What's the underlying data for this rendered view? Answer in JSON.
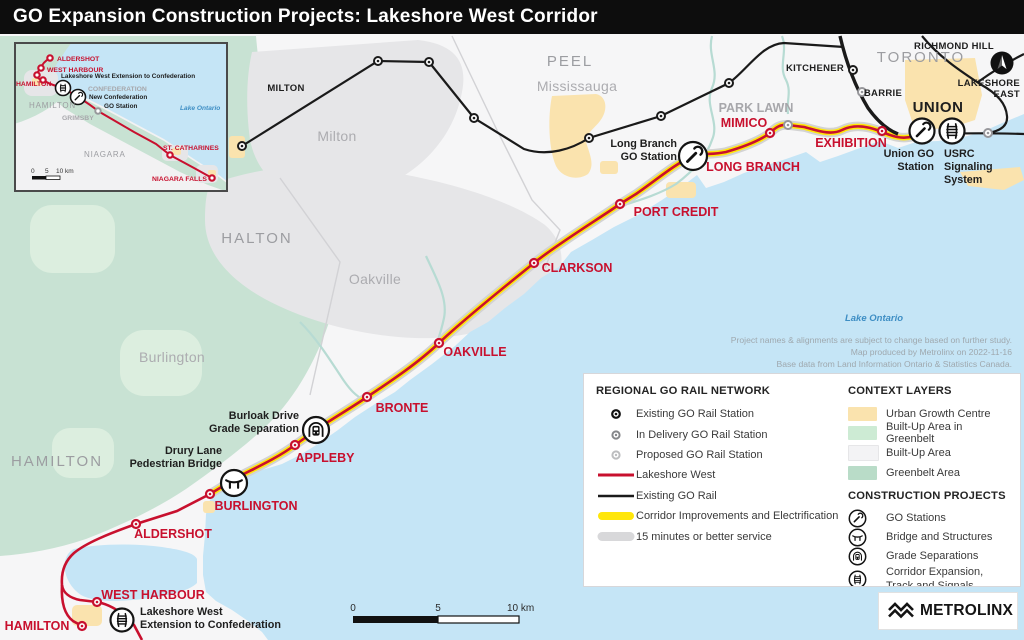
{
  "title": "GO Expansion Construction Projects: Lakeshore West Corridor",
  "regions": {
    "peel": "PEEL",
    "mississauga": "Mississauga",
    "milton": "Milton",
    "halton": "HALTON",
    "oakville": "Oakville",
    "burlington": "Burlington",
    "hamilton": "HAMILTON",
    "toronto": "TORONTO"
  },
  "lines": {
    "milton": "MILTON",
    "kitchener": "KITCHENER",
    "barrie": "BARRIE",
    "richmond_hill": "RICHMOND HILL",
    "lakeshore_east_1": "LAKESHORE",
    "lakeshore_east_2": "EAST",
    "union": "UNION"
  },
  "stations": {
    "park_lawn": "PARK LAWN",
    "mimico": "MIMICO",
    "exhibition": "EXHIBITION",
    "long_branch": "LONG BRANCH",
    "port_credit": "PORT CREDIT",
    "clarkson": "CLARKSON",
    "oakville": "OAKVILLE",
    "bronte": "BRONTE",
    "appleby": "APPLEBY",
    "burlington": "BURLINGTON",
    "aldershot": "ALDERSHOT",
    "west_harbour": "WEST HARBOUR",
    "hamilton": "HAMILTON"
  },
  "projects": {
    "long_branch_go_1": "Long Branch",
    "long_branch_go_2": "GO Station",
    "union_go_1": "Union GO",
    "union_go_2": "Station",
    "usrc_1": "USRC",
    "usrc_2": "Signaling",
    "usrc_3": "System",
    "burloak_1": "Burloak Drive",
    "burloak_2": "Grade Separation",
    "drury_1": "Drury Lane",
    "drury_2": "Pedestrian Bridge",
    "ext_1": "Lakeshore West",
    "ext_2": "Extension to Confederation"
  },
  "water": {
    "lake_ontario": "Lake Ontario"
  },
  "notes": {
    "line1": "Project names & alignments are subject to change based on further study.",
    "line2": "Map produced by Metrolinx on 2022-11-16",
    "line3": "Base data from Land Information Ontario & Statistics Canada."
  },
  "scalebar": {
    "zero": "0",
    "five": "5",
    "ten": "10 km"
  },
  "inset": {
    "aldershot": "ALDERSHOT",
    "west_harbour": "WEST HARBOUR",
    "hamilton": "HAMILTON",
    "extension": "Lakeshore West Extension to Confederation",
    "confederation": "CONFEDERATION",
    "new_conf_1": "New Confederation",
    "new_conf_2": "GO Station",
    "hamilton_region": "HAMILTON",
    "grimsby": "GRIMSBY",
    "niagara": "NIAGARA",
    "st_catharines": "ST. CATHARINES",
    "niagara_falls": "NIAGARA FALLS",
    "lake_ontario": "Lake Ontario",
    "scale_zero": "0",
    "scale_five": "5",
    "scale_ten": "10 km"
  },
  "legend": {
    "network_title": "REGIONAL GO RAIL NETWORK",
    "network_items": [
      "Existing GO Rail Station",
      "In Delivery GO Rail Station",
      "Proposed GO Rail Station",
      "Lakeshore West",
      "Existing GO Rail",
      "Corridor Improvements and Electrification",
      "15 minutes or better service"
    ],
    "context_title": "CONTEXT LAYERS",
    "context_items": [
      "Urban Growth Centre",
      "Built-Up Area in Greenbelt",
      "Built-Up Area",
      "Greenbelt Area"
    ],
    "projects_title": "CONSTRUCTION PROJECTS",
    "project_items": [
      "GO Stations",
      "Bridge and Structures",
      "Grade Separations",
      "Corridor Expansion, Track and Signals"
    ]
  },
  "logo": {
    "name": "METROLINX"
  },
  "colors": {
    "lakeshore_west": "#C8102E",
    "existing_rail": "#1A1A1A",
    "electrification": "#FFE60A",
    "service_15min": "#D3D3D3",
    "urban_growth": "#FAE3AE",
    "builtup_greenbelt": "#DCEEDF",
    "builtup": "#E6E6E8",
    "greenbelt": "#C8E2D3",
    "water": "#C5E5F6"
  }
}
